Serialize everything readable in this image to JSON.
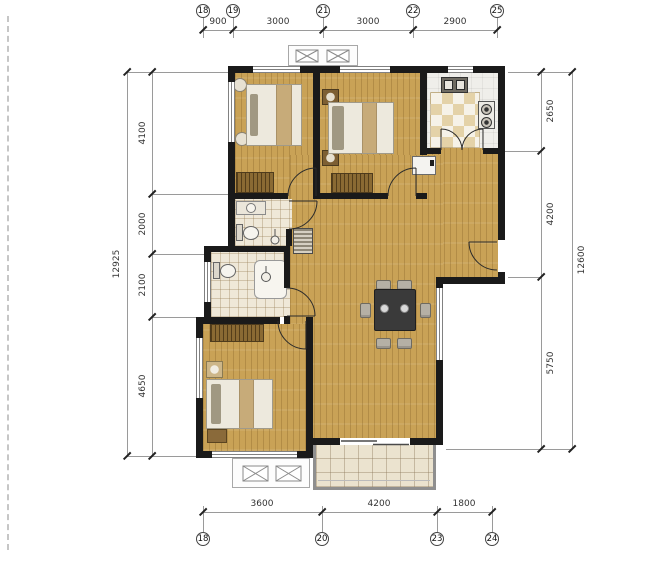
{
  "drawing_type": "residential floor plan",
  "grid": {
    "top_bubbles": [
      "18",
      "19",
      "21",
      "22",
      "25"
    ],
    "bottom_bubbles": [
      "18",
      "20",
      "23",
      "24"
    ]
  },
  "dimensions": {
    "top": [
      "900",
      "3000",
      "3000",
      "2900"
    ],
    "bottom": [
      "3600",
      "4200",
      "1800"
    ],
    "left_segments": [
      "4100",
      "2000",
      "2100",
      "4650"
    ],
    "left_total": "12925",
    "right_segments": [
      "2650",
      "4200",
      "5750"
    ],
    "right_total": "12600"
  },
  "colors": {
    "wall": "#1a1a1a",
    "wood_floor": "#c9a256",
    "bath_tile": "#efe8d8",
    "kitchen_tile": "#efeeea",
    "balcony_tile": "#ebe3cf",
    "dining_set_dark": "#3a3a3a",
    "wardrobe_brown": "#8a6a33",
    "dim_text": "#333333"
  }
}
